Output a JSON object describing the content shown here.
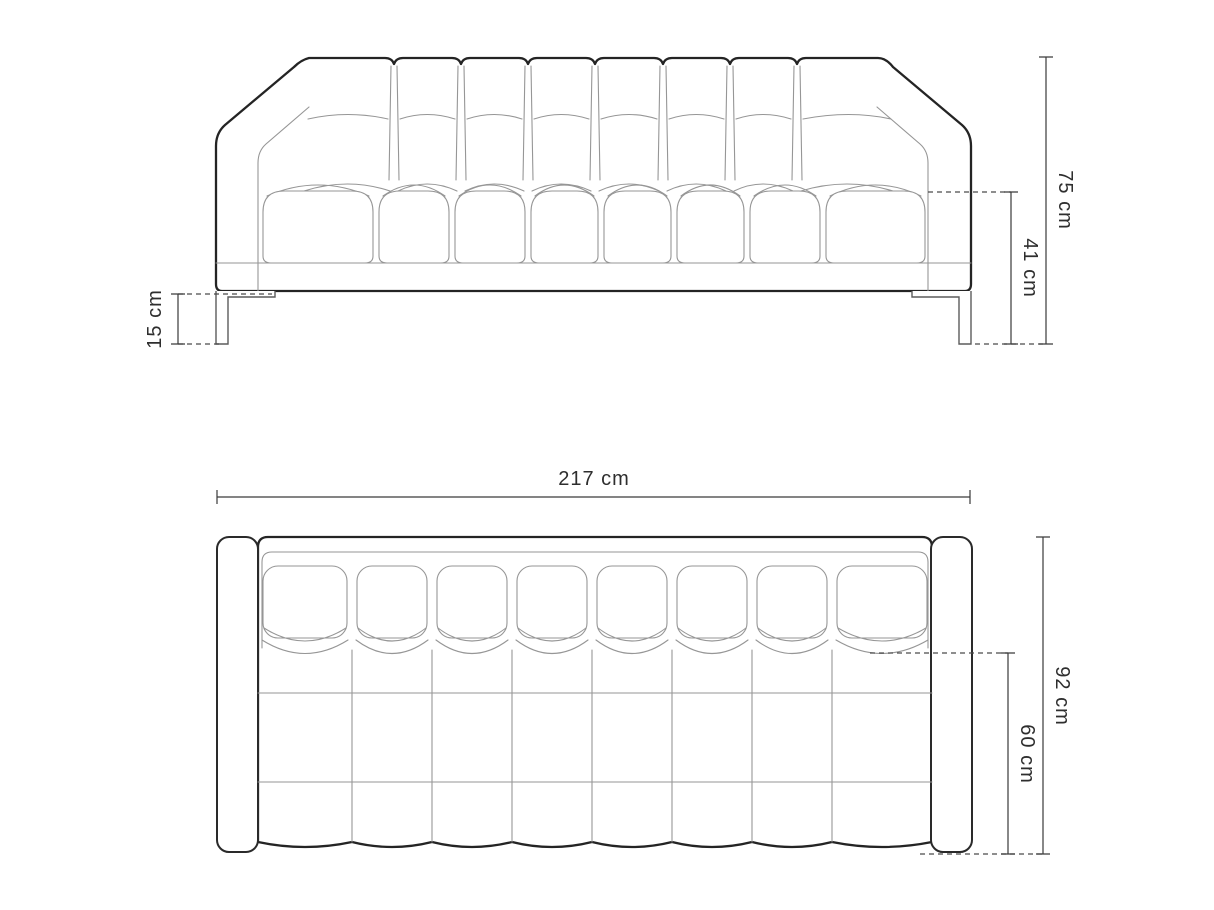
{
  "page": {
    "background": "#ffffff"
  },
  "drawing": {
    "type": "furniture-dimension-diagram",
    "subject": "sofa technical drawing, front elevation and top plan",
    "line_colors": {
      "outline": "#242424",
      "detail": "#969696",
      "dimension": "#3a3a3a"
    },
    "front_view": {
      "dimensions": {
        "overall_height": "75 cm",
        "seat_height": "41 cm",
        "leg_height": "15 cm"
      }
    },
    "top_view": {
      "dimensions": {
        "overall_width": "217 cm",
        "overall_depth": "92 cm",
        "seat_depth": "60 cm"
      }
    }
  }
}
